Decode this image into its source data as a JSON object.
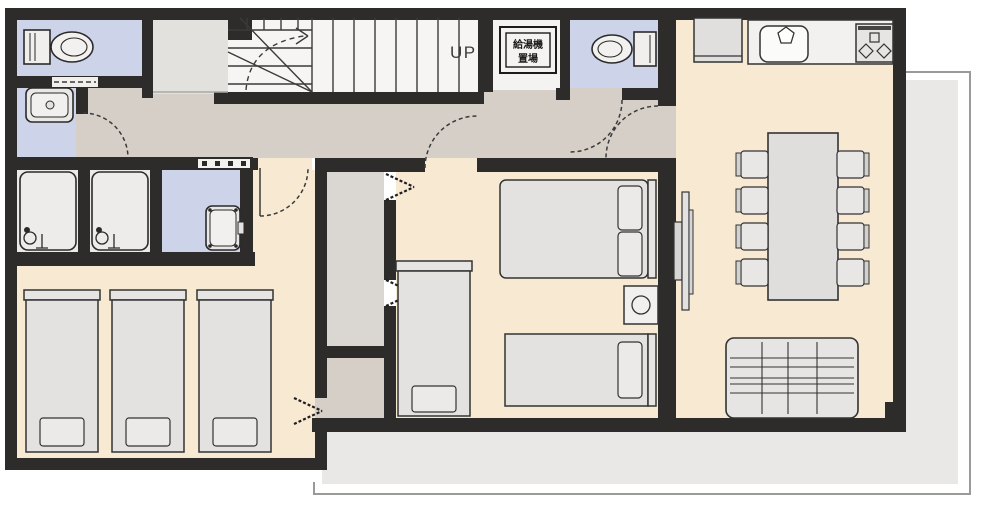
{
  "labels": {
    "stairs_direction": "UP",
    "water_heater_line1": "給湯機",
    "water_heater_line2": "置場"
  },
  "colors": {
    "wall": "#2e2c2b",
    "room_floor_cream": "#f8e9d3",
    "hallway_floor_taupe": "#d6cfc8",
    "wet_room_floor_blue": "#cdd4ea",
    "stair_floor_white": "#f6f5f3",
    "landing_floor_gray": "#e3e1de",
    "closet_floor_gray": "#dad6d2",
    "bath_floor": "#eceae7",
    "furniture_fill": "#e3e2e0",
    "balcony_floor": "#e9e8e6",
    "outline": "#333333"
  },
  "rooms": [
    {
      "name": "toilet-1",
      "floor": "blue",
      "furniture": [
        "toilet"
      ]
    },
    {
      "name": "powder-room",
      "floor": "blue",
      "furniture": [
        "washbasin"
      ]
    },
    {
      "name": "bathroom-1",
      "floor": "white",
      "furniture": [
        "bathtub",
        "faucet"
      ]
    },
    {
      "name": "bathroom-2",
      "floor": "white",
      "furniture": [
        "bathtub",
        "faucet"
      ]
    },
    {
      "name": "washroom",
      "floor": "blue",
      "furniture": [
        "vanity"
      ]
    },
    {
      "name": "bedroom-triple",
      "floor": "cream",
      "furniture": [
        "single-bed",
        "single-bed",
        "single-bed"
      ]
    },
    {
      "name": "hallway",
      "floor": "taupe",
      "furniture": []
    },
    {
      "name": "staircase",
      "floor": "white",
      "furniture": [
        "winder-stairs",
        "walking-line"
      ]
    },
    {
      "name": "water-heater-closet",
      "floor": "white",
      "furniture": [
        "water-heater-unit"
      ]
    },
    {
      "name": "toilet-2",
      "floor": "blue",
      "furniture": [
        "toilet"
      ]
    },
    {
      "name": "closet-upper",
      "floor": "gray",
      "furniture": [
        "bifold-doors"
      ]
    },
    {
      "name": "closet-lower",
      "floor": "taupe",
      "furniture": [
        "bifold-door"
      ]
    },
    {
      "name": "bedroom-family",
      "floor": "cream",
      "furniture": [
        "single-bed",
        "double-bed",
        "single-bed",
        "side-table"
      ]
    },
    {
      "name": "living-dining-kitchen",
      "floor": "cream",
      "furniture": [
        "refrigerator",
        "kitchen-sink",
        "stove",
        "dining-table",
        "chair-x8",
        "sofa",
        "tv"
      ]
    },
    {
      "name": "balcony",
      "floor": "gray",
      "furniture": []
    }
  ]
}
